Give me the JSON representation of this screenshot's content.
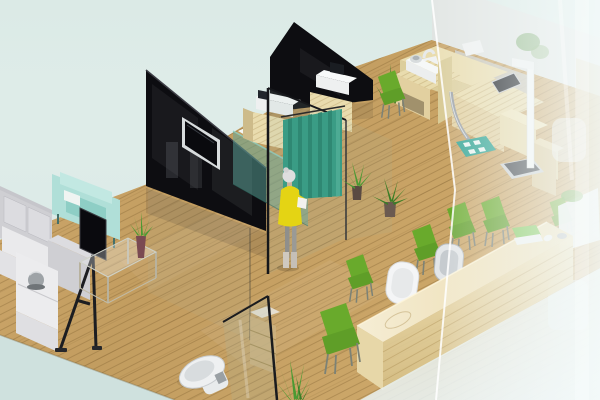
{
  "scene": {
    "title": "3D isometric cutaway rendering of a clinic interior with lounge, exam room, reception desk and toilet",
    "objects": [
      {
        "id": "wood-floor",
        "label": "wooden plank floor"
      },
      {
        "id": "l-shaped-sofa",
        "label": "light grey L-shaped sofa"
      },
      {
        "id": "mint-armchair",
        "label": "mint green armchair"
      },
      {
        "id": "display-easel",
        "label": "black display screen on tripod easel"
      },
      {
        "id": "glass-coffee-table",
        "label": "glass coffee table with plant vase"
      },
      {
        "id": "black-wall-tv",
        "label": "black partition wall with mounted TV"
      },
      {
        "id": "glass-display-cabinet",
        "label": "teal glass display cabinet"
      },
      {
        "id": "printer-cabinets",
        "label": "wooden cabinets with white printers"
      },
      {
        "id": "privacy-curtain",
        "label": "teal privacy curtain"
      },
      {
        "id": "standing-person",
        "label": "woman in yellow dress standing at curtain"
      },
      {
        "id": "potted-plants",
        "label": "potted green plants"
      },
      {
        "id": "exam-desk",
        "label": "wooden examination desk with devices"
      },
      {
        "id": "height-scale",
        "label": "white height measuring scale with platform"
      },
      {
        "id": "green-chairs",
        "label": "green waiting chairs"
      },
      {
        "id": "reception-desk",
        "label": "long wooden reception counter"
      },
      {
        "id": "reception-laptop",
        "label": "green laptop with mouse"
      },
      {
        "id": "office-chairs",
        "label": "white and grey office chairs"
      },
      {
        "id": "toilet",
        "label": "white toilet"
      },
      {
        "id": "storage-shelf",
        "label": "wooden storage shelf"
      },
      {
        "id": "glass-partitions",
        "label": "glass partition walls"
      },
      {
        "id": "frosted-glass-wall",
        "label": "frosted glass facade on the right"
      }
    ]
  },
  "colors": {
    "background_top": "#dbeae6",
    "background_bottom": "#cfe1de",
    "floor": "#c9a468",
    "wall_black": "#0d0d11",
    "tv_screen": "#0a0a0e",
    "tv_frame": "#d8dcdd",
    "glass_cabinet": "#5ba79b",
    "curtain": "#3a9c85",
    "curtain_shade": "#2e8571",
    "wood_light": "#e9dcae",
    "desk_front": "#e2d0a0",
    "reception_top": "#f2e7c8",
    "sofa": "#dcdce0",
    "sofa_shade": "#c6c6cb",
    "armchair_mint": "#b0dfd8",
    "chair_green": "#69aa2c",
    "chair_green_dark": "#5f9e28",
    "plant_green": "#4a9a33",
    "plant_green_dark": "#3a7d26",
    "dress_yellow": "#e4d414",
    "hair_grey": "#dedede",
    "metal": "#9aa0a6",
    "toilet_white": "#eef0f1",
    "mat_teal": "#2aa190",
    "laptop_green": "#7cc654",
    "platform_dark": "#3a3e44"
  }
}
